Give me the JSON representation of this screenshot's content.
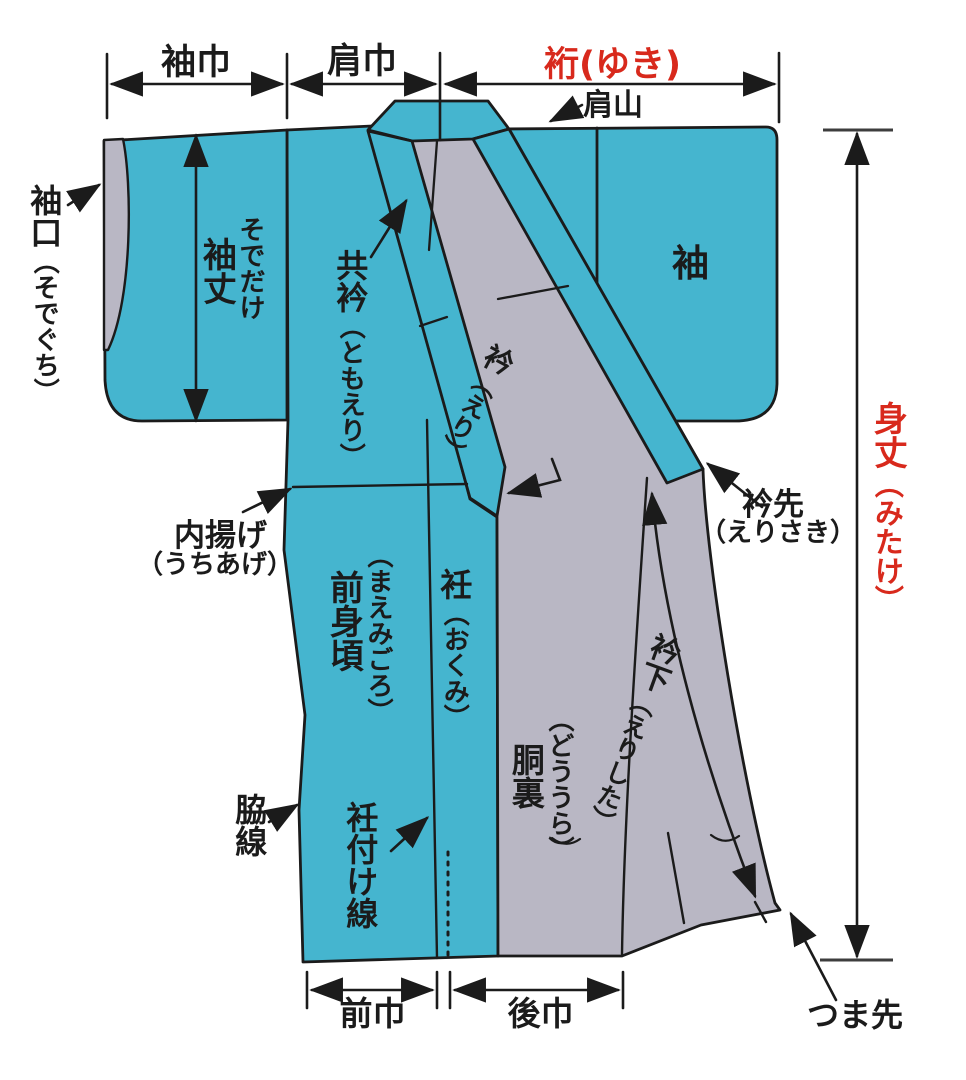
{
  "diagram": {
    "type": "kimono-parts-diagram",
    "colors": {
      "fabric_teal": "#45b5cf",
      "lining_gray": "#b9b7c4",
      "accent_red": "#d8291c",
      "line_black": "#1b1b1b"
    },
    "top_dimensions": {
      "sode_haba": "袖巾",
      "kata_haba": "肩巾",
      "yuki": "裄(ゆき)"
    },
    "labels": {
      "kata_yama": "肩山",
      "sodeguchi": {
        "main": "袖口",
        "reading": "（そでぐち）"
      },
      "sodetake": {
        "reading": "そでだけ",
        "main": "袖丈"
      },
      "tomoeri": {
        "main": "共衿",
        "reading": "（ともえり）"
      },
      "eri": {
        "main": "衿",
        "reading": "（えり）"
      },
      "sode": "袖",
      "mitake": {
        "main": "身丈",
        "reading": "（みたけ）"
      },
      "uchiage": {
        "main": "内揚げ",
        "reading": "（うちあげ）"
      },
      "erisaki": {
        "main": "衿先",
        "reading": "（えりさき）"
      },
      "maemigoro": {
        "reading": "（まえみごろ）",
        "main": "前身頃"
      },
      "okumi": {
        "main": "衽",
        "reading": "（おくみ）"
      },
      "douura": {
        "reading": "（どううら）",
        "main": "胴裏"
      },
      "erishita": {
        "main": "衿下",
        "reading": "（えりした）"
      },
      "wakisen": "脇線",
      "okumitsuke_sen": "衽付け線",
      "tsumasaki": "つま先"
    },
    "bottom_dimensions": {
      "mae_haba": "前巾",
      "ushiro_haba": "後巾"
    }
  }
}
